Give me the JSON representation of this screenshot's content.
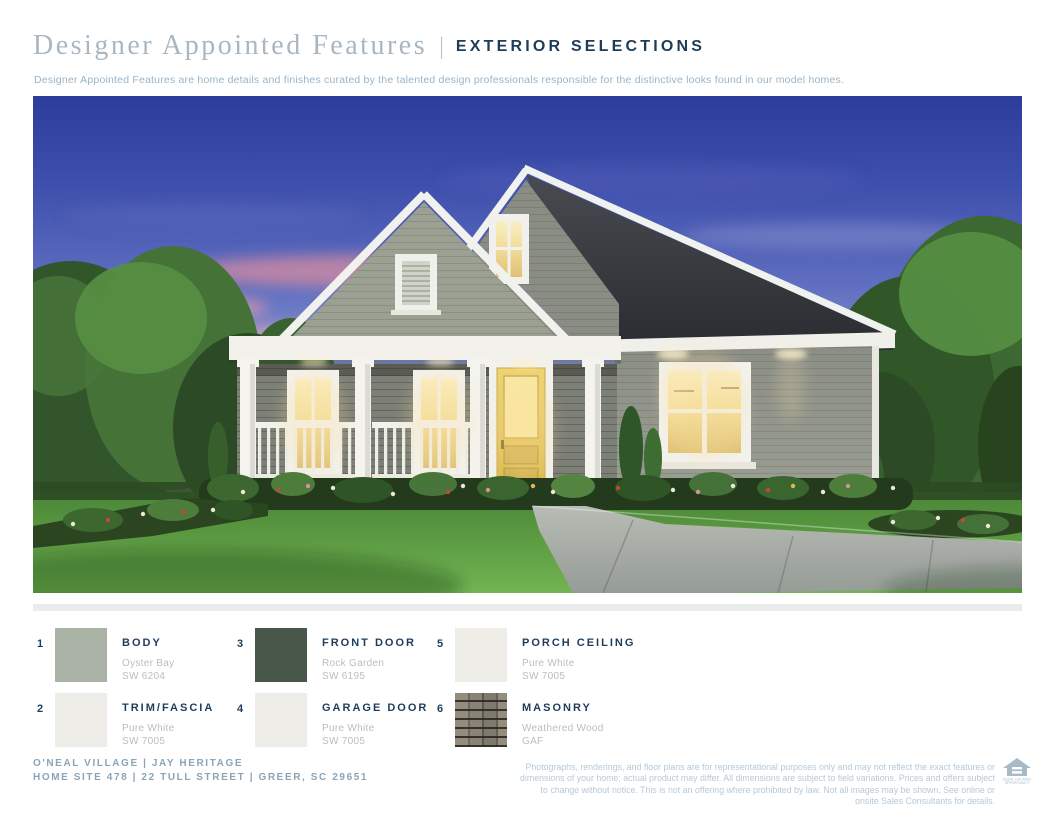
{
  "header": {
    "title_serif": "Designer Appointed Features",
    "separator": "|",
    "title_section": "EXTERIOR SELECTIONS",
    "subtitle": "Designer Appointed Features are home details and finishes curated by the talented design professionals responsible for the distinctive looks found in our model homes."
  },
  "hero": {
    "alt": "Dusk rendering of a single-story gray cottage with two front gables, a covered porch with white columns and railing, a yellow front door, warmly lit windows, landscaped flower beds, green lawn and a concrete walkway, flanked by trees under a pink-and-blue evening sky."
  },
  "selections": [
    {
      "number": "1",
      "label": "BODY",
      "product": "Oyster Bay",
      "code": "SW 6204",
      "swatch_style": "background:#abb2a6"
    },
    {
      "number": "2",
      "label": "TRIM/FASCIA",
      "product": "Pure White",
      "code": "SW 7005",
      "swatch_style": "background:#eeede8"
    },
    {
      "number": "3",
      "label": "FRONT DOOR",
      "product": "Rock Garden",
      "code": "SW 6195",
      "swatch_style": "background:#49574b"
    },
    {
      "number": "4",
      "label": "GARAGE DOOR",
      "product": "Pure White",
      "code": "SW 7005",
      "swatch_style": "background:#eeede8"
    },
    {
      "number": "5",
      "label": "PORCH CEILING",
      "product": "Pure White",
      "code": "SW 7005",
      "swatch_style": "background:#eeede8"
    },
    {
      "number": "6",
      "label": "MASONRY",
      "product": "Weathered Wood",
      "code": "GAF",
      "swatch_style": "background-color:#7d776b;background-image:repeating-linear-gradient(180deg, rgba(43,41,34,0) 0px, rgba(43,41,34,0) 7px, rgba(43,41,34,0.9) 7px, rgba(43,41,34,0.9) 9px),repeating-linear-gradient(90deg, #948d7d 0px, #948d7d 13px, #6e695f 13px, #6e695f 15px, #898375 15px, #898375 27px, #5d594f 27px, #5d594f 29px, #7f7a6d 29px, #7f7a6d 41px, #665f54 41px, #665f54 43px)"
    }
  ],
  "footer": {
    "line1": "O'NEAL VILLAGE  |  JAY HERITAGE",
    "line2": "HOME SITE 478  |  22 TULL STREET  |  GREER, SC 29651",
    "disclaimer": "Photographs, renderings, and floor plans are for representational purposes only and may not reflect the exact features or dimensions of your home; actual product may differ. All dimensions are subject to field variations. Prices and offers subject to change without notice. This is not an offering where prohibited by law. Not all images may be shown. See online or onsite Sales Consultants for details.",
    "eho_line1": "EQUAL HOUSING",
    "eho_line2": "OPPORTUNITY"
  },
  "colors": {
    "title_muted_serif": "#a9b7c3",
    "title_navy": "#1e3c58",
    "subtitle_blue": "#9cb4c6",
    "footer_blue": "#8ba4b6",
    "disclaimer_blue": "#b6c9d7",
    "divider_gray": "#e8eceb",
    "swatch_oyster_bay": "#abb2a6",
    "swatch_pure_white": "#eeede8",
    "swatch_rock_garden": "#49574b",
    "door_yellow": "#e3c35c"
  }
}
